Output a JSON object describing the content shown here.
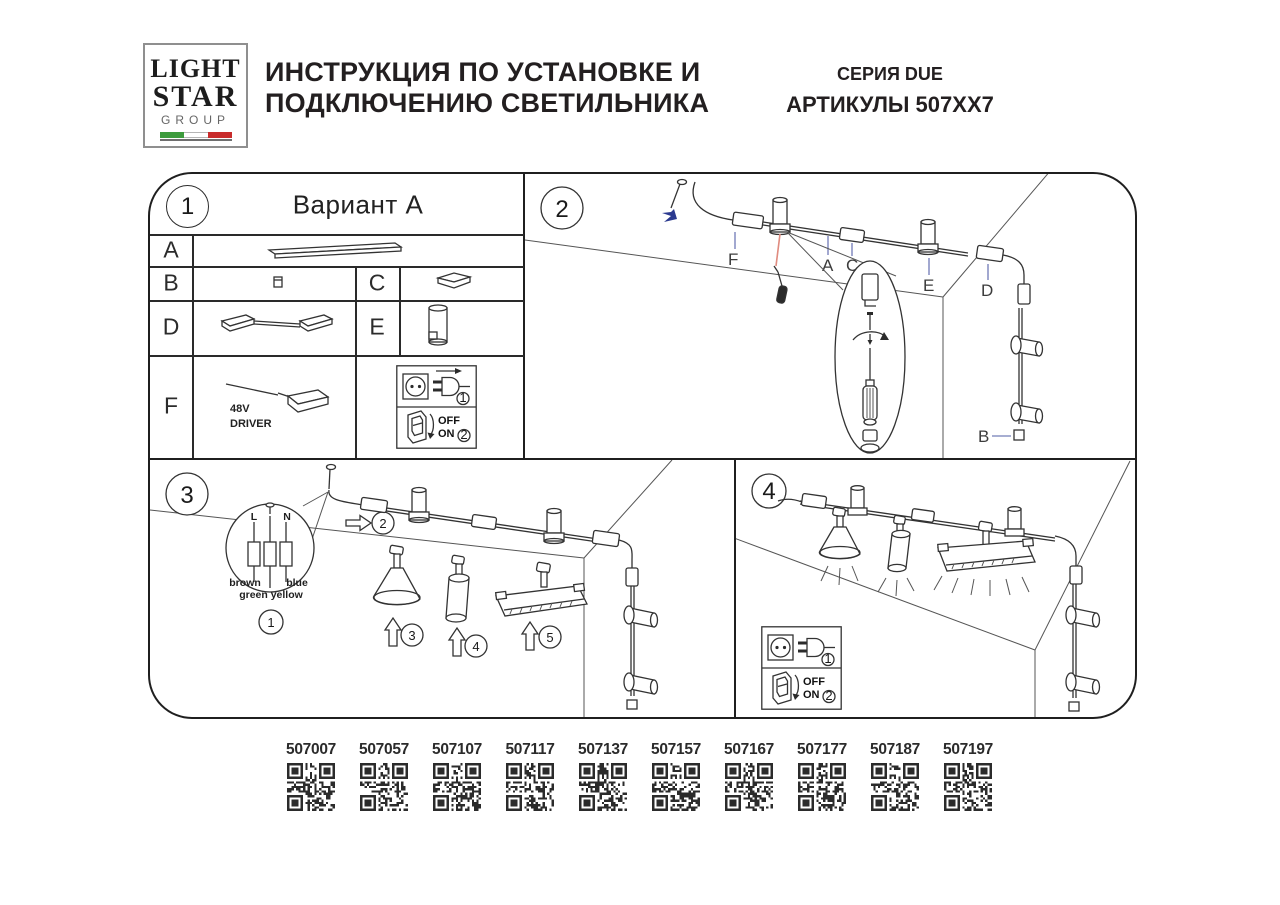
{
  "header": {
    "logo": {
      "line1": "LIGHT",
      "line2": "STAR",
      "line3": "GROUP"
    },
    "title_line1": "ИНСТРУКЦИЯ ПО УСТАНОВКЕ И",
    "title_line2": "ПОДКЛЮЧЕНИЮ СВЕТИЛЬНИКА",
    "series": "СЕРИЯ DUE",
    "articles_label": "АРТИКУЛЫ 507XX7"
  },
  "panel1": {
    "number": "1",
    "title": "Вариант A",
    "letters": {
      "a": "A",
      "b": "B",
      "c": "C",
      "d": "D",
      "e": "E",
      "f": "F"
    },
    "driver_line1": "48V",
    "driver_line2": "DRIVER",
    "plug_step": "1",
    "switch_step": "2",
    "off_label": "OFF",
    "on_label": "ON"
  },
  "panel2": {
    "number": "2",
    "labels": {
      "f": "F",
      "a": "A",
      "c": "C",
      "e": "E",
      "d": "D",
      "b": "B"
    }
  },
  "panel3": {
    "number": "3",
    "wiring": {
      "l": "L",
      "n": "N",
      "brown": "brown",
      "blue": "blue",
      "green_yellow": "green yellow"
    },
    "step1": "1",
    "step2": "2",
    "step3": "3",
    "step4": "4",
    "step5": "5"
  },
  "panel4": {
    "number": "4",
    "plug_step": "1",
    "switch_step": "2",
    "off_label": "OFF",
    "on_label": "ON"
  },
  "qr_codes": {
    "articles": [
      "507007",
      "507057",
      "507107",
      "507117",
      "507137",
      "507157",
      "507167",
      "507177",
      "507187",
      "507197"
    ]
  },
  "colors": {
    "ink": "#2f2f2f",
    "leader_blue": "#8a93c4",
    "arrow_blue": "#2b3a8f",
    "leader_red": "#e08b7f",
    "flag_green": "#3d9b3d",
    "flag_red": "#c82b2b",
    "text": "#231f20"
  }
}
